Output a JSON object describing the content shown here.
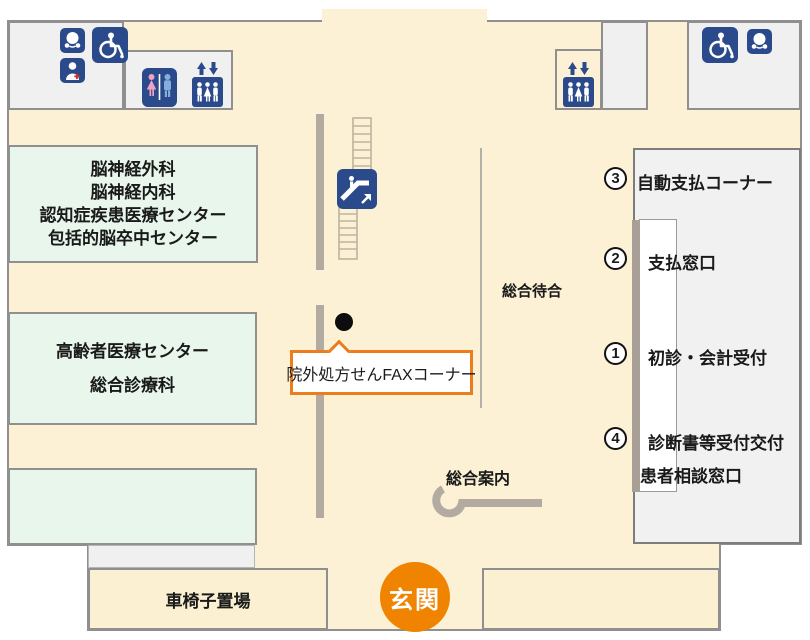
{
  "colors": {
    "floor": "#FCF1D4",
    "accent_orange": "#F08300",
    "icon_navy": "#2B4A8B",
    "room_green": "#E9F6EC",
    "facility_gray": "#F0F0F0",
    "wall_gray": "#B3ABA1",
    "counter_taupe": "#A89F96",
    "toilet_pink": "#F2A3C3",
    "toilet_blue": "#85AEDC"
  },
  "rooms": {
    "neurology": {
      "lines": [
        "脳神経外科",
        "脳神経内科",
        "認知症疾患医療センター",
        "包括的脳卒中センター"
      ]
    },
    "geriatrics": {
      "lines": [
        "高齢者医療センター",
        "総合診療科"
      ]
    }
  },
  "reception": {
    "items": [
      {
        "num": "3",
        "label": "自動支払コーナー"
      },
      {
        "num": "2",
        "label": "支払窓口"
      },
      {
        "num": "1",
        "label": "初診・会計受付"
      },
      {
        "num": "4",
        "label": "診断書等受付交付"
      }
    ],
    "sub_label": "患者相談窓口"
  },
  "labels": {
    "general_waiting": "総合待合",
    "general_information": "総合案内",
    "fax_corner": "院外処方せんFAXコーナー",
    "wheelchair_storage": "車椅子置場",
    "entrance": "玄関"
  },
  "icons": {
    "top_left": [
      "baby-care-icon",
      "wheelchair-icon",
      "staff-icon",
      "toilet-icon",
      "elevator-icon"
    ],
    "center": [
      "escalator-icon"
    ],
    "top_right": [
      "elevator-icon",
      "wheelchair-icon",
      "baby-care-icon"
    ]
  }
}
